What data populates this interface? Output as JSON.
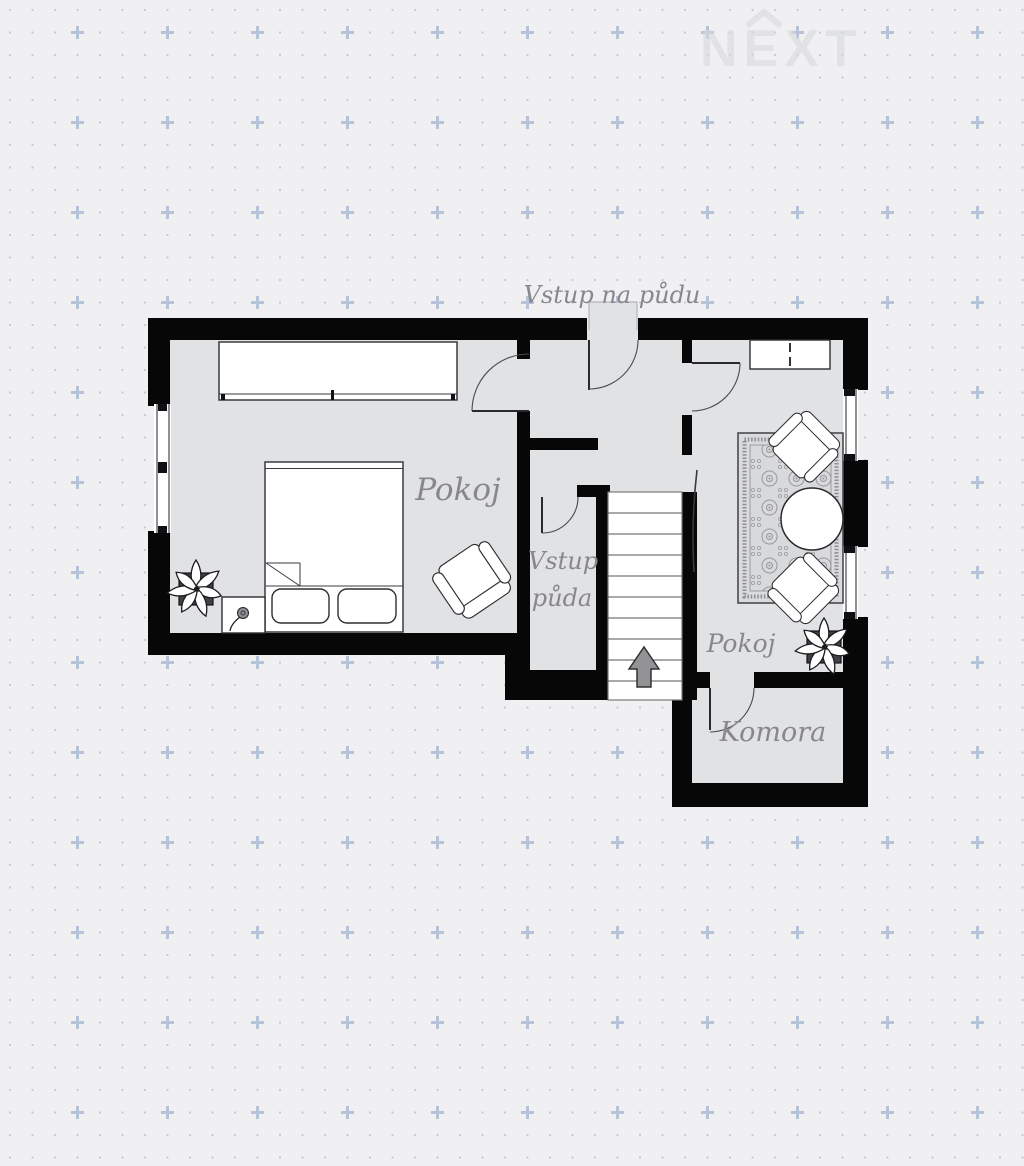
{
  "watermark": {
    "brand": "NEXT"
  },
  "labels": {
    "attic_entry": "Vstup na půdu",
    "room_left": "Pokoj",
    "closet_line1": "Vstup",
    "closet_line2": "půda",
    "room_right": "Pokoj",
    "storage": "Komora"
  },
  "rooms": [
    {
      "name": "Pokoj",
      "furniture": [
        "wardrobe",
        "double-bed",
        "nightstand",
        "flower",
        "plant",
        "armchair"
      ]
    },
    {
      "name": "Vstup půda",
      "furniture": [
        "staircase",
        "up-arrow"
      ]
    },
    {
      "name": "Pokoj",
      "furniture": [
        "dresser",
        "rug",
        "armchair",
        "armchair",
        "round-table",
        "plant"
      ]
    },
    {
      "name": "Komora",
      "furniture": []
    }
  ],
  "colors": {
    "background": "#f0f0f2",
    "floor": "#e1e2e4",
    "wall": "#070708",
    "label": "#88888c",
    "pattern_dot": "#c7c8cb",
    "pattern_plus": "#b5c2d8",
    "stair_arrow": "#939396",
    "watermark": "#d9dade"
  }
}
